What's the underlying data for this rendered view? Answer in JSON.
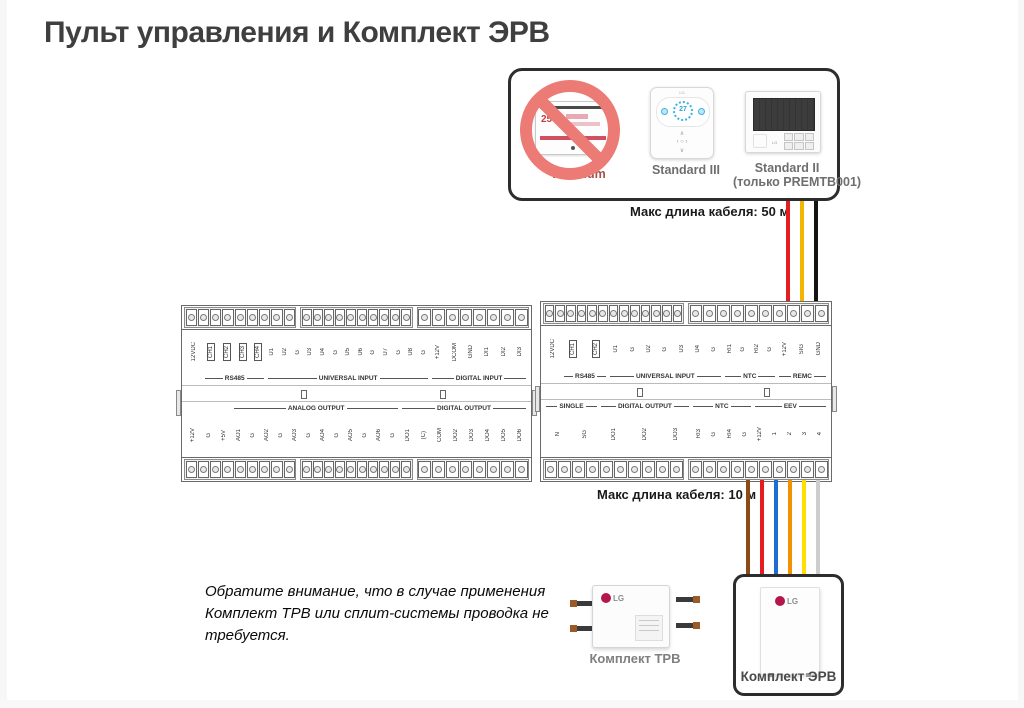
{
  "page": {
    "title": "Пульт управления и Комплект ЭРВ"
  },
  "remote_box": {
    "items": [
      {
        "label": "Premium",
        "banned": true,
        "screen": "25",
        "brand": "LG"
      },
      {
        "label": "Standard III",
        "screen": "27",
        "brand": "LG"
      },
      {
        "label": "Standard II",
        "sublabel": "(только PREMTB001)",
        "brand": "LG"
      }
    ]
  },
  "cable_labels": {
    "top": "Макс длина кабеля: 50 м",
    "bottom": "Макс длина кабеля: 10 м"
  },
  "wires": {
    "top": [
      {
        "color": "#e41d20"
      },
      {
        "color": "#f2b600"
      },
      {
        "color": "#141414"
      }
    ],
    "bottom": [
      {
        "color": "#8c4a15"
      },
      {
        "color": "#e41d20"
      },
      {
        "color": "#1d6ed1"
      },
      {
        "color": "#f39200"
      },
      {
        "color": "#ffdf00"
      },
      {
        "color": "#cdcdcd"
      }
    ]
  },
  "modules": {
    "left": {
      "top_strip": [
        9,
        10,
        8
      ],
      "bottom_strip": [
        9,
        10,
        8
      ],
      "top_sections": [
        {
          "name": "",
          "pins": [
            "12VDC"
          ]
        },
        {
          "name": "RS485",
          "boxed": true,
          "pins": [
            "CH1",
            "CH2",
            "CH3",
            "CH4"
          ]
        },
        {
          "name": "UNIVERSAL INPUT",
          "pins": [
            "U1",
            "U2",
            "G",
            "U3",
            "U4",
            "G",
            "U5",
            "U6",
            "G",
            "U7",
            "G",
            "U8",
            "G"
          ]
        },
        {
          "name": "DIGITAL INPUT",
          "pins": [
            "+12V",
            "DCOM",
            "GND",
            "DI1",
            "DI2",
            "DI3"
          ]
        }
      ],
      "bottom_sections": [
        {
          "name": "",
          "pins": [
            "+12V",
            "G",
            "+5V"
          ]
        },
        {
          "name": "ANALOG OUTPUT",
          "pins": [
            "AO1",
            "G",
            "AO2",
            "G",
            "AO3",
            "G",
            "AO4",
            "G",
            "AO5",
            "G",
            "AO6",
            "G"
          ]
        },
        {
          "name": "DIGITAL OUTPUT",
          "pins": [
            "DO1",
            "(C)",
            "COM",
            "DO2",
            "DO3",
            "DO4",
            "DO5",
            "DO6"
          ]
        }
      ]
    },
    "right": {
      "top_strip": [
        13,
        10
      ],
      "bottom_strip": [
        10,
        10
      ],
      "top_sections": [
        {
          "name": "",
          "pins": [
            "12VDC"
          ]
        },
        {
          "name": "RS485",
          "boxed": true,
          "pins": [
            "CH1",
            "CH2"
          ]
        },
        {
          "name": "UNIVERSAL INPUT",
          "pins": [
            "U1",
            "G",
            "U2",
            "G",
            "U3",
            "U4",
            "G"
          ]
        },
        {
          "name": "NTC",
          "pins": [
            "RI1",
            "G",
            "RI2",
            "G"
          ]
        },
        {
          "name": "REMC",
          "pins": [
            "+12V",
            "SIG",
            "GND"
          ]
        }
      ],
      "bottom_sections": [
        {
          "name": "SINGLE",
          "pins": [
            "N",
            "SG"
          ]
        },
        {
          "name": "DIGITAL OUTPUT",
          "pins": [
            "DO1",
            "DO2",
            "DO3"
          ]
        },
        {
          "name": "NTC",
          "pins": [
            "RI3",
            "G",
            "RI4",
            "G"
          ]
        },
        {
          "name": "EEV",
          "pins": [
            "+12V",
            "1",
            "2",
            "3",
            "4"
          ]
        }
      ]
    }
  },
  "note": {
    "text": "Обратите внимание, что в случае применения Комплект ТРВ или сплит-системы проводка не требуется."
  },
  "trv": {
    "label": "Комплект ТРВ",
    "brand": "LG"
  },
  "erv": {
    "label": "Комплект ЭРВ",
    "brand": "LG"
  }
}
